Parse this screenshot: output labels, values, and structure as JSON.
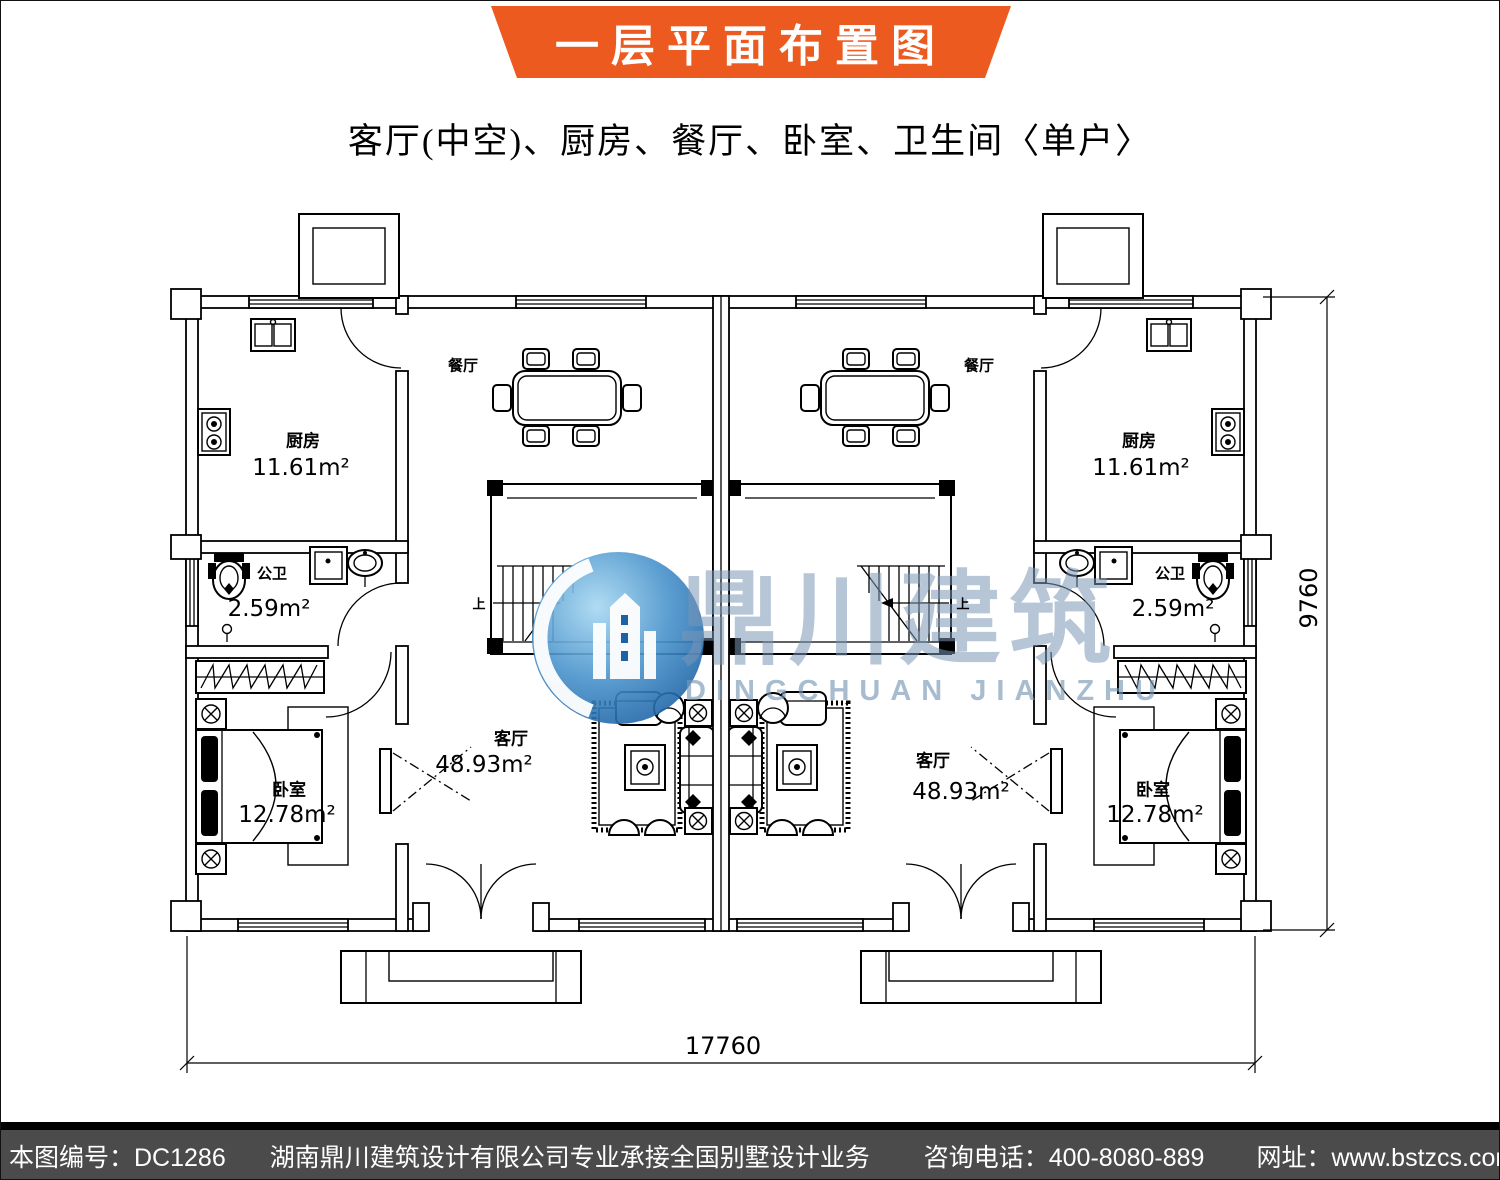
{
  "banner": {
    "title": "一层平面布置图"
  },
  "subtitle": "客厅(中空)、厨房、餐厅、卧室、卫生间〈单户〉",
  "watermark": {
    "cn": "鼎川建筑",
    "en": "DINGCHUAN JIANZHU"
  },
  "rooms": {
    "kitchen": {
      "name": "厨房",
      "area": "11.61m²"
    },
    "bath": {
      "name": "公卫",
      "area": "2.59m²"
    },
    "bedroom": {
      "name": "卧室",
      "area": "12.78m²"
    },
    "dining": {
      "name": "餐厅"
    },
    "living": {
      "name": "客厅",
      "area": "48.93m²"
    },
    "stair": {
      "up": "上"
    }
  },
  "dimensions": {
    "total_width": "17760",
    "total_depth": "9760"
  },
  "footer": {
    "drawing_no": "本图编号：DC1286",
    "company": "湖南鼎川建筑设计有限公司专业承接全国别墅设计业务",
    "phone": "咨询电话：400-8080-889",
    "website": "网址：www.bstzcs.com"
  },
  "colors": {
    "banner_orange": "#ec5a20",
    "footer_gray": "#4b4b4b",
    "watermark_blue": "#2e7fc0",
    "line_black": "#000000"
  }
}
